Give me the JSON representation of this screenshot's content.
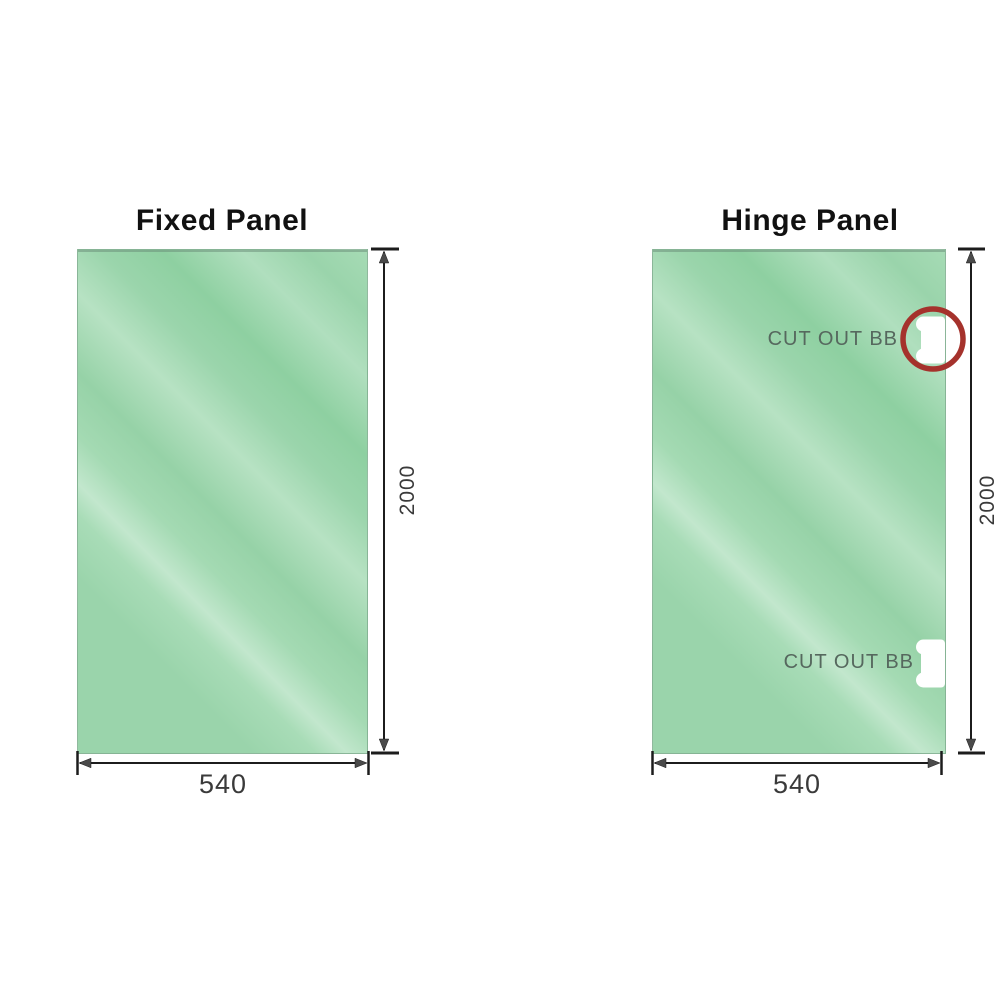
{
  "diagram": {
    "panels": [
      {
        "title": "Fixed Panel",
        "height_label": "2000",
        "width_label": "540",
        "cutouts": []
      },
      {
        "title": "Hinge Panel",
        "height_label": "2000",
        "width_label": "540",
        "cutouts": [
          {
            "label": "CUT OUT BB",
            "position": "top",
            "circled": true
          },
          {
            "label": "CUT OUT BB",
            "position": "bottom",
            "circled": false
          }
        ]
      }
    ],
    "colors": {
      "glass_green": "#9ad4ab",
      "glass_green_light": "#c2e7cd",
      "line_color": "#1c1c1c",
      "arrow_gray": "#4a4a4a",
      "ring_red": "#a5322c",
      "dim_text": "#3a3a3a",
      "cutout_text": "#56685e",
      "title_text": "#111111"
    }
  }
}
